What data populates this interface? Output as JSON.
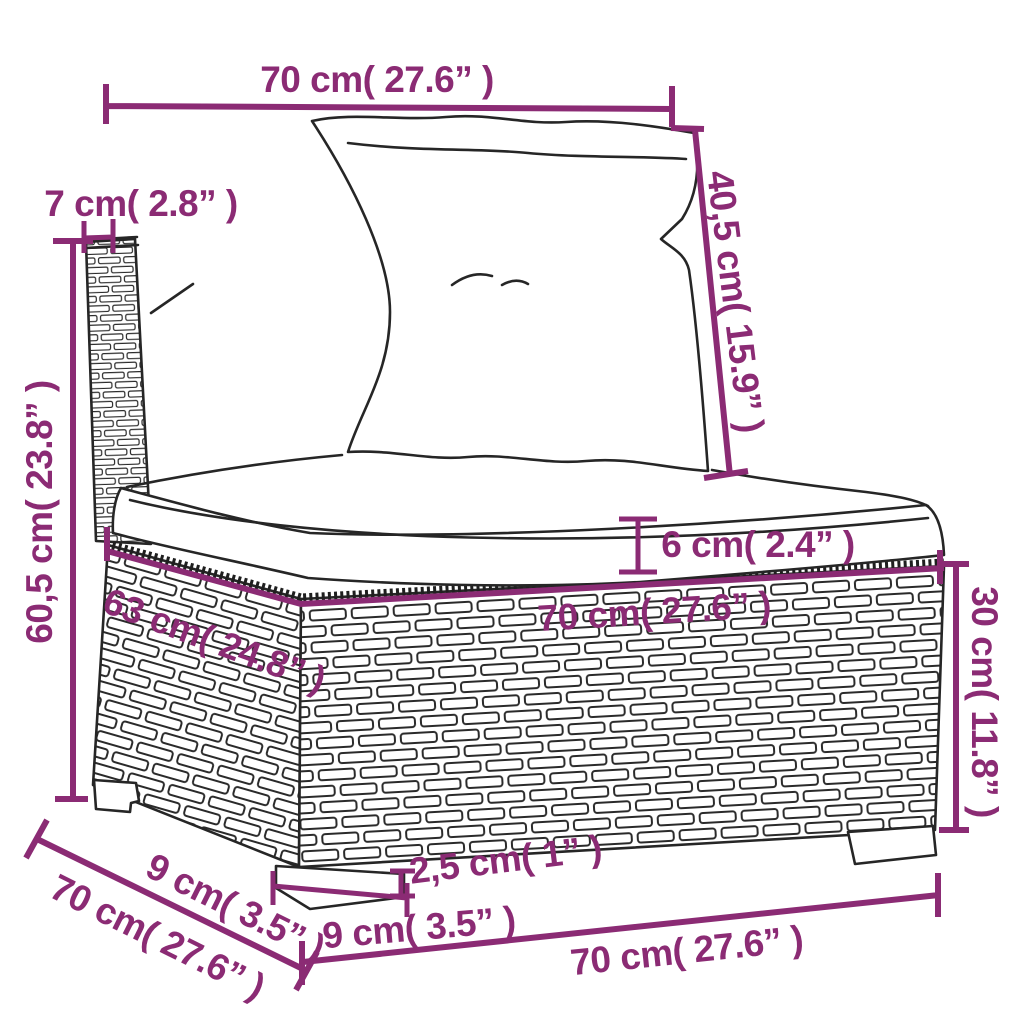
{
  "diagram": {
    "figure": "poly-rattan-middle-sofa-section-with-cushions",
    "colors": {
      "dimension_color": "#8b2b74",
      "line_art_color": "#262626",
      "background": "#ffffff"
    },
    "labels": {
      "top_width": "70 cm( 27.6” )",
      "back_cushion_height": "40,5 cm( 15.9” )",
      "back_frame_width": "7 cm( 2.8” )",
      "total_height": "60,5 cm( 23.8” )",
      "seat_cushion_thickness": "6 cm( 2.4” )",
      "seat_depth": "63 cm( 24.8” )",
      "seat_width": "70 cm( 27.6” )",
      "base_height": "30 cm( 11.8” )",
      "overall_depth": "70 cm( 27.6” )",
      "leg_inset": "9 cm( 3.5” )",
      "leg_width": "9 cm( 3.5” )",
      "leg_height": "2,5 cm( 1” )",
      "base_width": "70 cm( 27.6” )"
    }
  }
}
